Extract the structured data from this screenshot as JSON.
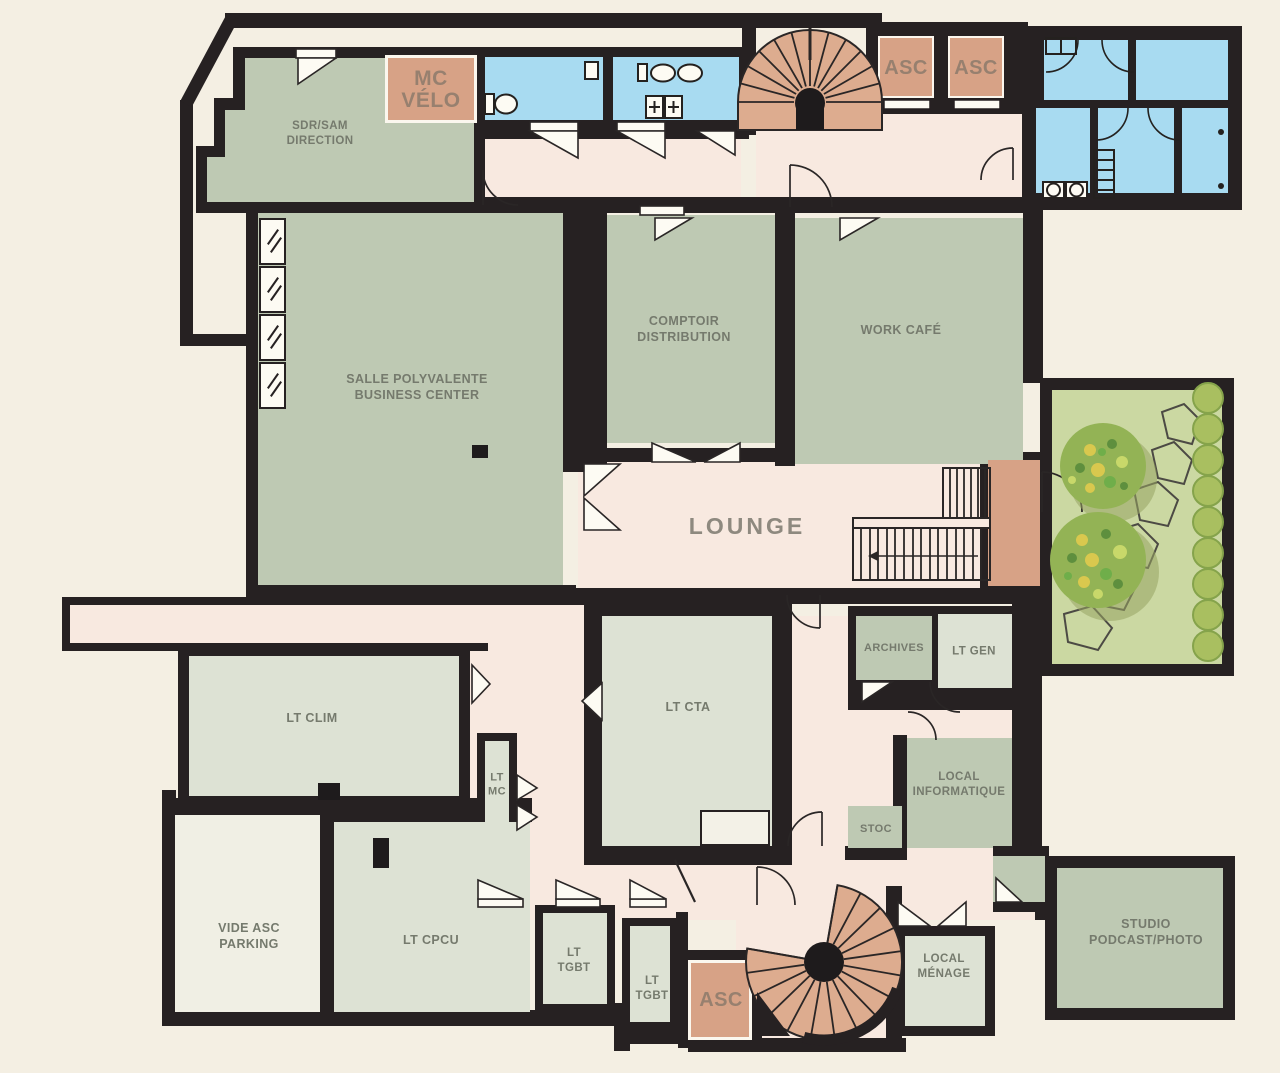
{
  "plan_title": "Floor plan",
  "rooms": {
    "sdr_sam": {
      "label": "SDR/SAM\nDIRECTION"
    },
    "mc_velo": {
      "label": "MC\nVÉLO"
    },
    "asc_top_1": {
      "label": "ASC"
    },
    "asc_top_2": {
      "label": "ASC"
    },
    "salle_polyvalente": {
      "label": "SALLE POLYVALENTE\nBUSINESS CENTER"
    },
    "comptoir": {
      "label": "COMPTOIR\nDISTRIBUTION"
    },
    "work_cafe": {
      "label": "WORK CAFÉ"
    },
    "lounge": {
      "label": "LOUNGE"
    },
    "archives": {
      "label": "ARCHIVES"
    },
    "lt_gen": {
      "label": "LT GEN"
    },
    "local_informatique": {
      "label": "LOCAL\nINFORMATIQUE"
    },
    "stoc": {
      "label": "STOC"
    },
    "lt_clim": {
      "label": "LT CLIM"
    },
    "lt_mc": {
      "label": "LT\nMC"
    },
    "lt_cta": {
      "label": "LT CTA"
    },
    "vide_asc": {
      "label": "VIDE ASC\nPARKING"
    },
    "lt_cpcu": {
      "label": "LT CPCU"
    },
    "lt_tgbt_1": {
      "label": "LT\nTGBT"
    },
    "lt_tgbt_2": {
      "label": "LT\nTGBT"
    },
    "asc_bottom": {
      "label": "ASC"
    },
    "local_menage": {
      "label": "LOCAL\nMÉNAGE"
    },
    "studio": {
      "label": "STUDIO\nPODCAST/PHOTO"
    }
  },
  "colors": {
    "background": "#f4efe3",
    "walls": "#262122",
    "meeting_rooms": "#bec9b3",
    "technical_rooms": "#dde2d4",
    "circulation": "#f8e9e0",
    "sanitary": "#a8dbf1",
    "elevators_stairs": "#d7a286",
    "garden": "#cbd8a2",
    "void": "#f0efe4"
  }
}
